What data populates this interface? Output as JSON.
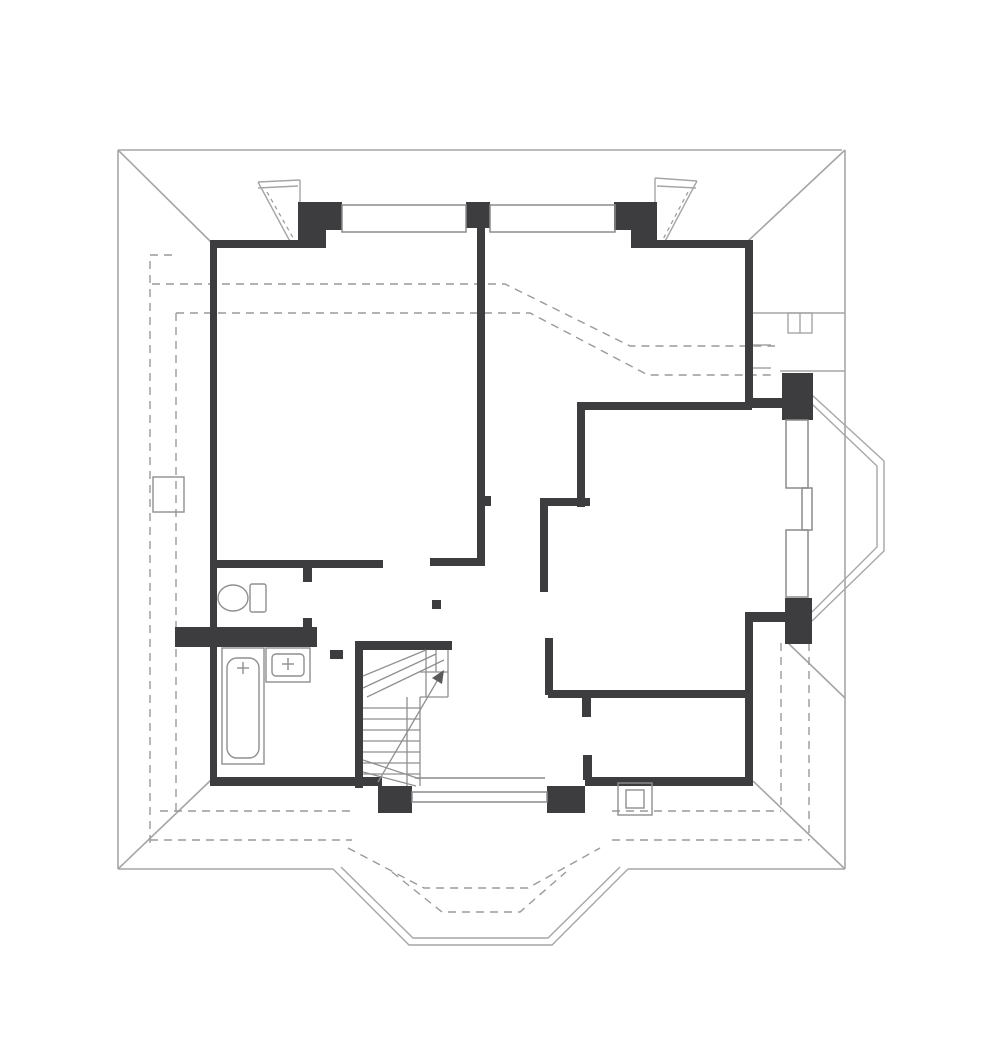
{
  "canvas": {
    "width": 999,
    "height": 1062,
    "background": "#ffffff"
  },
  "colors": {
    "wall": "#3d3d40",
    "thin": "#a6a6a6",
    "dashed": "#9a9a9a",
    "frame": "#8c8c8c",
    "fixture": "#8f8f8f",
    "arrow": "#5a5a5a"
  },
  "floorplan": {
    "groups": [
      {
        "name": "roof-outline",
        "stroke": "thin",
        "sw": 1.6,
        "prims": [
          [
            "l",
            118,
            150,
            842,
            150
          ],
          [
            "l",
            118,
            150,
            118,
            869
          ],
          [
            "l",
            118,
            869,
            333,
            869
          ],
          [
            "l",
            628,
            869,
            845,
            869
          ],
          [
            "l",
            845,
            150,
            845,
            869
          ],
          [
            "l",
            118,
            150,
            211,
            242
          ],
          [
            "l",
            845,
            150,
            748,
            241
          ],
          [
            "l",
            118,
            869,
            211,
            780
          ],
          [
            "l",
            845,
            869,
            753,
            781
          ],
          [
            "l",
            788,
            643,
            845,
            698
          ]
        ]
      },
      {
        "name": "bay-east-roof-outline",
        "stroke": "thin",
        "sw": 1.4,
        "prims": [
          [
            "pl",
            812,
            395,
            884,
            461,
            884,
            551,
            812,
            621
          ],
          [
            "pl",
            812,
            404,
            877,
            466,
            877,
            547,
            812,
            612
          ]
        ]
      },
      {
        "name": "bay-south-roof-outline",
        "stroke": "thin",
        "sw": 1.4,
        "prims": [
          [
            "pl",
            333,
            869,
            409,
            945,
            552,
            945,
            628,
            869
          ],
          [
            "pl",
            341,
            867,
            413,
            938,
            548,
            938,
            620,
            867
          ]
        ]
      },
      {
        "name": "terrace-outline",
        "stroke": "thin",
        "sw": 1.4,
        "prims": [
          [
            "l",
            748,
            313,
            845,
            313
          ],
          [
            "l",
            780,
            371,
            845,
            371
          ],
          [
            "r",
            788,
            313,
            24,
            20,
            0
          ],
          [
            "l",
            800,
            313,
            800,
            333
          ],
          [
            "l",
            753,
            345,
            771,
            345
          ],
          [
            "l",
            753,
            368,
            771,
            368
          ]
        ]
      },
      {
        "name": "roof-pitch-dashed-lines",
        "stroke": "dashed",
        "sw": 1.4,
        "dash": "8 6",
        "prims": [
          [
            "pl",
            152,
            284,
            505,
            284,
            630,
            346,
            775,
            346
          ],
          [
            "pl",
            176,
            313,
            530,
            313,
            648,
            375,
            775,
            375
          ],
          [
            "pl",
            172,
            255,
            150,
            255,
            150,
            843
          ],
          [
            "l",
            176,
            313,
            176,
            811
          ],
          [
            "l",
            160,
            811,
            352,
            811
          ],
          [
            "l",
            612,
            811,
            781,
            811
          ],
          [
            "l",
            150,
            840,
            352,
            840
          ],
          [
            "l",
            612,
            840,
            809,
            840
          ],
          [
            "l",
            781,
            643,
            781,
            811
          ],
          [
            "l",
            809,
            643,
            809,
            840
          ],
          [
            "pl",
            348,
            848,
            424,
            888,
            528,
            888,
            600,
            848
          ],
          [
            "pl",
            392,
            872,
            442,
            912,
            520,
            912,
            566,
            872
          ]
        ]
      },
      {
        "name": "dormer-dashed-lines",
        "stroke": "dashed",
        "sw": 1.2,
        "dash": "4 4",
        "prims": [
          [
            "l",
            267,
            192,
            296,
            243
          ],
          [
            "l",
            688,
            192,
            661,
            243
          ]
        ]
      },
      {
        "name": "dormer-left-outline",
        "stroke": "thin",
        "sw": 1.4,
        "prims": [
          [
            "l",
            258,
            182,
            300,
            180
          ],
          [
            "l",
            258,
            188,
            298,
            186
          ],
          [
            "l",
            258,
            182,
            293,
            247
          ],
          [
            "l",
            300,
            180,
            300,
            203
          ]
        ]
      },
      {
        "name": "dormer-right-outline",
        "stroke": "thin",
        "sw": 1.4,
        "prims": [
          [
            "l",
            655,
            178,
            697,
            181
          ],
          [
            "l",
            657,
            186,
            696,
            188
          ],
          [
            "l",
            697,
            181,
            662,
            247
          ],
          [
            "l",
            655,
            178,
            655,
            203
          ]
        ]
      },
      {
        "name": "walls",
        "fill": "wall",
        "prims": [
          [
            "r",
            210,
            240,
            96,
            8,
            1
          ],
          [
            "r",
            298,
            202,
            44,
            28,
            1
          ],
          [
            "r",
            298,
            230,
            28,
            18,
            1
          ],
          [
            "r",
            466,
            202,
            24,
            26,
            1
          ],
          [
            "r",
            614,
            202,
            43,
            28,
            1
          ],
          [
            "r",
            631,
            230,
            26,
            18,
            1
          ],
          [
            "r",
            655,
            240,
            95,
            8,
            1
          ],
          [
            "r",
            210,
            240,
            7,
            545,
            1
          ],
          [
            "r",
            210,
            777,
            172,
            9,
            1
          ],
          [
            "r",
            585,
            777,
            167,
            9,
            1
          ],
          [
            "r",
            745,
            240,
            8,
            168,
            1
          ],
          [
            "r",
            745,
            398,
            40,
            10,
            1
          ],
          [
            "r",
            782,
            373,
            31,
            47,
            1
          ],
          [
            "r",
            785,
            598,
            27,
            46,
            1
          ],
          [
            "r",
            745,
            612,
            42,
            10,
            1
          ],
          [
            "r",
            745,
            612,
            8,
            174,
            1
          ],
          [
            "r",
            378,
            786,
            34,
            27,
            1
          ],
          [
            "r",
            547,
            786,
            38,
            27,
            1
          ],
          [
            "r",
            477,
            228,
            8,
            338,
            1
          ],
          [
            "r",
            430,
            558,
            50,
            8,
            1
          ],
          [
            "r",
            212,
            560,
            171,
            8,
            1
          ],
          [
            "r",
            303,
            568,
            9,
            14,
            1
          ],
          [
            "r",
            303,
            618,
            9,
            11,
            1
          ],
          [
            "r",
            175,
            627,
            142,
            20,
            1
          ],
          [
            "r",
            355,
            641,
            97,
            9,
            1
          ],
          [
            "r",
            355,
            641,
            8,
            147,
            1
          ],
          [
            "r",
            577,
            402,
            175,
            8,
            1
          ],
          [
            "r",
            577,
            402,
            8,
            105,
            1
          ],
          [
            "r",
            540,
            498,
            50,
            8,
            1
          ],
          [
            "r",
            540,
            498,
            8,
            94,
            1
          ],
          [
            "r",
            545,
            638,
            8,
            57,
            1
          ],
          [
            "r",
            548,
            690,
            197,
            8,
            1
          ],
          [
            "r",
            582,
            698,
            9,
            19,
            1
          ],
          [
            "r",
            583,
            755,
            9,
            25,
            1
          ],
          [
            "r",
            484,
            496,
            7,
            10,
            1
          ],
          [
            "r",
            432,
            600,
            9,
            9,
            1
          ],
          [
            "r",
            330,
            650,
            13,
            9,
            1
          ]
        ]
      },
      {
        "name": "window-north-left",
        "stroke": "frame",
        "sw": 1.5,
        "prims": [
          [
            "r",
            342,
            205,
            124,
            27,
            0
          ]
        ]
      },
      {
        "name": "window-north-right",
        "stroke": "frame",
        "sw": 1.5,
        "prims": [
          [
            "r",
            490,
            205,
            125,
            27,
            0
          ]
        ]
      },
      {
        "name": "window-south",
        "stroke": "frame",
        "sw": 1.5,
        "prims": [
          [
            "r",
            412,
            792,
            135,
            10,
            0
          ],
          [
            "l",
            415,
            778,
            545,
            778
          ]
        ]
      },
      {
        "name": "bay-windows-east",
        "stroke": "frame",
        "sw": 1.5,
        "prims": [
          [
            "r",
            786,
            420,
            22,
            68,
            0
          ],
          [
            "r",
            802,
            488,
            10,
            42,
            0
          ],
          [
            "r",
            786,
            530,
            22,
            67,
            0
          ]
        ]
      },
      {
        "name": "staircase",
        "stroke": "fixture",
        "sw": 1.3,
        "fill": "arrow",
        "prims": [
          [
            "l",
            448,
            650,
            448,
            697
          ],
          [
            "l",
            420,
            697,
            448,
            697
          ],
          [
            "l",
            420,
            697,
            420,
            786
          ],
          [
            "l",
            407,
            697,
            407,
            786
          ],
          [
            "l",
            363,
            708,
            420,
            708
          ],
          [
            "l",
            363,
            719,
            420,
            719
          ],
          [
            "l",
            363,
            730,
            420,
            730
          ],
          [
            "l",
            363,
            741,
            420,
            741
          ],
          [
            "l",
            363,
            752,
            420,
            752
          ],
          [
            "l",
            363,
            763,
            420,
            763
          ],
          [
            "l",
            363,
            774,
            420,
            774
          ],
          [
            "l",
            363,
            676,
            426,
            650
          ],
          [
            "l",
            363,
            688,
            436,
            654
          ],
          [
            "l",
            367,
            697,
            444,
            660
          ],
          [
            "l",
            426,
            650,
            426,
            697
          ],
          [
            "l",
            436,
            650,
            436,
            672
          ],
          [
            "l",
            420,
            672,
            448,
            672
          ],
          [
            "l",
            363,
            760,
            420,
            779
          ],
          [
            "l",
            363,
            772,
            416,
            786
          ],
          [
            "l",
            378,
            782,
            440,
            676
          ],
          [
            "pg",
            444,
            670,
            442,
            684,
            432,
            678
          ]
        ]
      },
      {
        "name": "toilet",
        "stroke": "fixture",
        "sw": 1.4,
        "prims": [
          [
            "r",
            250,
            584,
            16,
            28,
            0,
            2
          ],
          [
            "e",
            233,
            598,
            15,
            13
          ]
        ]
      },
      {
        "name": "bathtub",
        "stroke": "fixture",
        "sw": 1.4,
        "prims": [
          [
            "r",
            222,
            648,
            42,
            116,
            0
          ],
          [
            "r",
            227,
            658,
            32,
            100,
            0,
            10
          ],
          [
            "l",
            237,
            668,
            249,
            668
          ],
          [
            "l",
            243,
            662,
            243,
            674
          ]
        ]
      },
      {
        "name": "washbasin",
        "stroke": "fixture",
        "sw": 1.4,
        "prims": [
          [
            "r",
            266,
            648,
            44,
            34,
            0
          ],
          [
            "r",
            272,
            654,
            32,
            22,
            0,
            4
          ],
          [
            "l",
            282,
            664,
            294,
            664
          ],
          [
            "l",
            288,
            658,
            288,
            670
          ]
        ]
      },
      {
        "name": "chimney-left",
        "stroke": "fixture",
        "sw": 1.4,
        "prims": [
          [
            "r",
            153,
            477,
            31,
            35,
            0
          ]
        ]
      },
      {
        "name": "chimney-right",
        "stroke": "fixture",
        "sw": 1.4,
        "prims": [
          [
            "r",
            618,
            783,
            34,
            32,
            0
          ],
          [
            "r",
            626,
            790,
            18,
            18,
            0
          ]
        ]
      }
    ]
  }
}
